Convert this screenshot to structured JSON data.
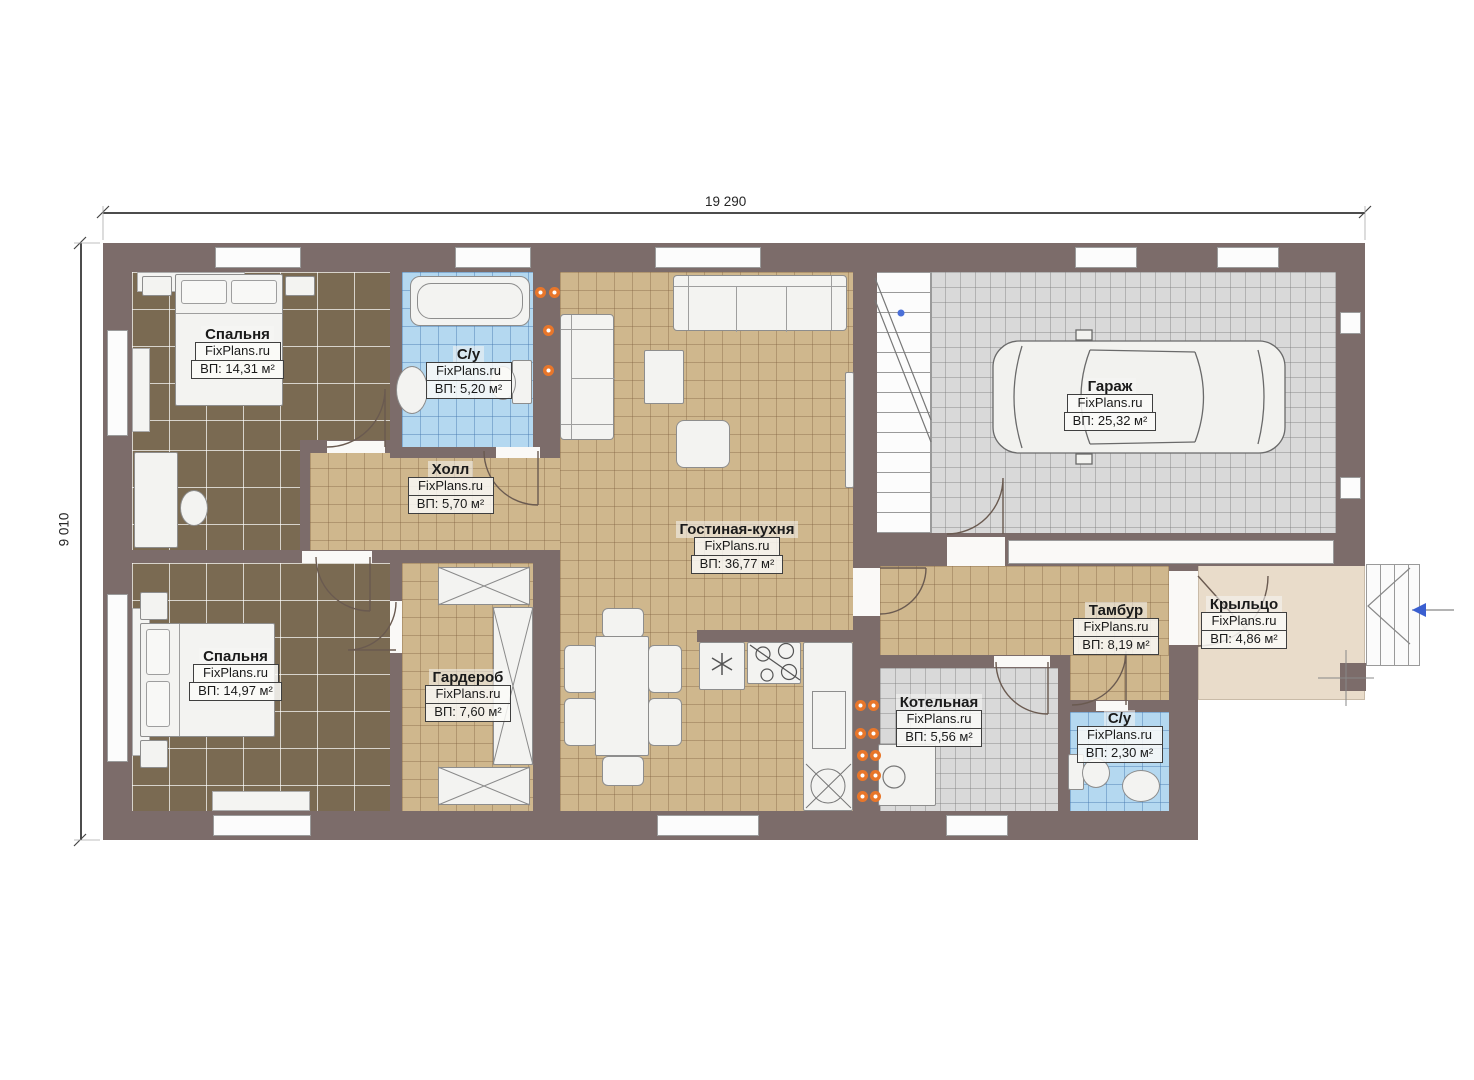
{
  "dimensions": {
    "width": "19 290",
    "height": "9 010"
  },
  "rooms": [
    {
      "name": "Спальня",
      "brand": "FixPlans.ru",
      "area": "ВП: 14,31 м²"
    },
    {
      "name": "С/у",
      "brand": "FixPlans.ru",
      "area": "ВП: 5,20 м²"
    },
    {
      "name": "Холл",
      "brand": "FixPlans.ru",
      "area": "ВП: 5,70 м²"
    },
    {
      "name": "Гостиная-кухня",
      "brand": "FixPlans.ru",
      "area": "ВП: 36,77 м²"
    },
    {
      "name": "Гараж",
      "brand": "FixPlans.ru",
      "area": "ВП: 25,32 м²"
    },
    {
      "name": "Спальня",
      "brand": "FixPlans.ru",
      "area": "ВП: 14,97 м²"
    },
    {
      "name": "Гардероб",
      "brand": "FixPlans.ru",
      "area": "ВП: 7,60 м²"
    },
    {
      "name": "Тамбур",
      "brand": "FixPlans.ru",
      "area": "ВП: 8,19 м²"
    },
    {
      "name": "Крыльцо",
      "brand": "FixPlans.ru",
      "area": "ВП: 4,86 м²"
    },
    {
      "name": "Котельная",
      "brand": "FixPlans.ru",
      "area": "ВП: 5,56 м²"
    },
    {
      "name": "С/у",
      "brand": "FixPlans.ru",
      "area": "ВП: 2,30 м²"
    }
  ],
  "colors": {
    "wall": "#7c6c6a",
    "floor_bedroom": "#7a6a52",
    "floor_tile_tan": "#cfb78d",
    "floor_bath": "#b4d8f0",
    "floor_garage": "#d9d9d9",
    "floor_porch": "#e9dcca",
    "accent_orange": "#e8762a",
    "marker_blue": "#4a6fd8"
  }
}
